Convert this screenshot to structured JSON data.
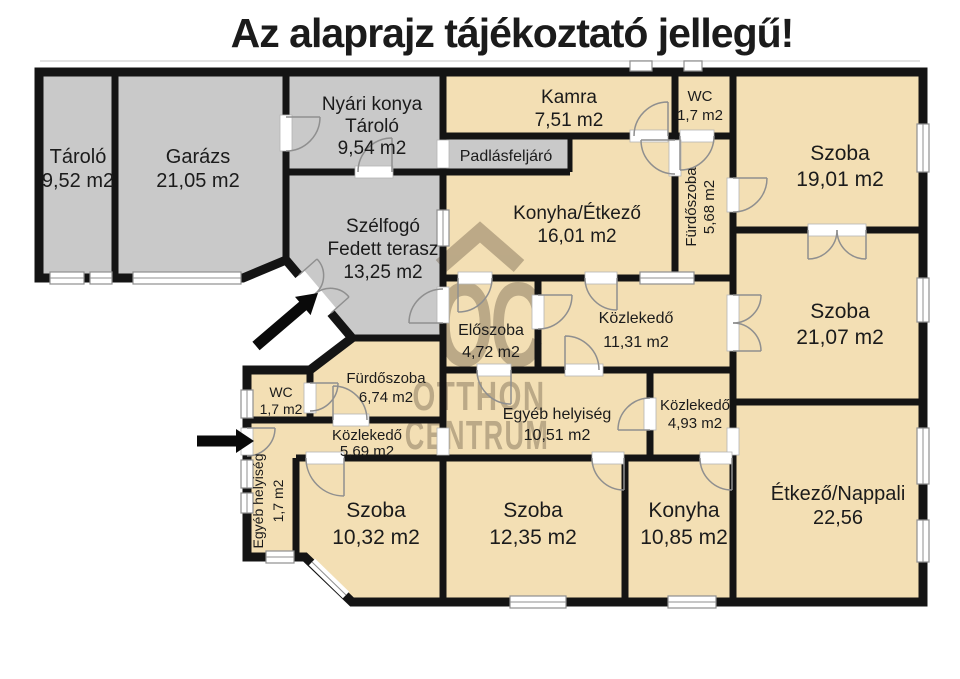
{
  "title": "Az alaprajz tájékoztató jellegű!",
  "watermark": {
    "monogram": "OC",
    "line1": "OTTHON",
    "line2": "CENTRUM"
  },
  "colors": {
    "wall": "#141414",
    "room_warm": "#f3dfb4",
    "room_cold": "#c9c9c9",
    "watermark": "#6f604a",
    "background": "#ffffff"
  },
  "rooms": {
    "tarolo": {
      "name": "Tároló",
      "area": "9,52 m2"
    },
    "garazs": {
      "name": "Garázs",
      "area": "21,05 m2"
    },
    "nyari_konyha": {
      "name": "Nyári konya",
      "name2": "Tároló",
      "area": "9,54 m2"
    },
    "kamra": {
      "name": "Kamra",
      "area": "7,51 m2"
    },
    "wc_felso": {
      "name": "WC",
      "area": "1,7 m2"
    },
    "szoba_1901": {
      "name": "Szoba",
      "area": "19,01 m2"
    },
    "padlasfeljaro": {
      "name": "Padlásfeljáró"
    },
    "furdoszoba_568": {
      "name": "Fürdőszoba",
      "area": "5,68 m2"
    },
    "konyha_etkezo": {
      "name": "Konyha/Étkező",
      "area": "16,01 m2"
    },
    "szelfogo": {
      "name": "Szélfogó",
      "name2": "Fedett terasz",
      "area": "13,25 m2"
    },
    "eloszoba": {
      "name": "Előszoba",
      "area": "4,72 m2"
    },
    "kozlekedo_1131": {
      "name": "Közlekedő",
      "area": "11,31 m2"
    },
    "szoba_2107": {
      "name": "Szoba",
      "area": "21,07 m2"
    },
    "wc_also": {
      "name": "WC",
      "area": "1,7 m2"
    },
    "furdoszoba_674": {
      "name": "Fürdőszoba",
      "area": "6,74 m2"
    },
    "egyeb_1051": {
      "name": "Egyéb helyiség",
      "area": "10,51 m2"
    },
    "kozlekedo_493": {
      "name": "Közlekedő",
      "area": "4,93 m2"
    },
    "kozlekedo_569": {
      "name": "Közlekedő",
      "area": "5,69 m2"
    },
    "egyeb_17": {
      "name": "Egyéb helyiség",
      "area": "1,7 m2"
    },
    "szoba_1032": {
      "name": "Szoba",
      "area": "10,32 m2"
    },
    "szoba_1235": {
      "name": "Szoba",
      "area": "12,35 m2"
    },
    "konyha": {
      "name": "Konyha",
      "area": "10,85 m2"
    },
    "etkezo_nappali": {
      "name": "Étkező/Nappali",
      "area": "22,56"
    }
  }
}
